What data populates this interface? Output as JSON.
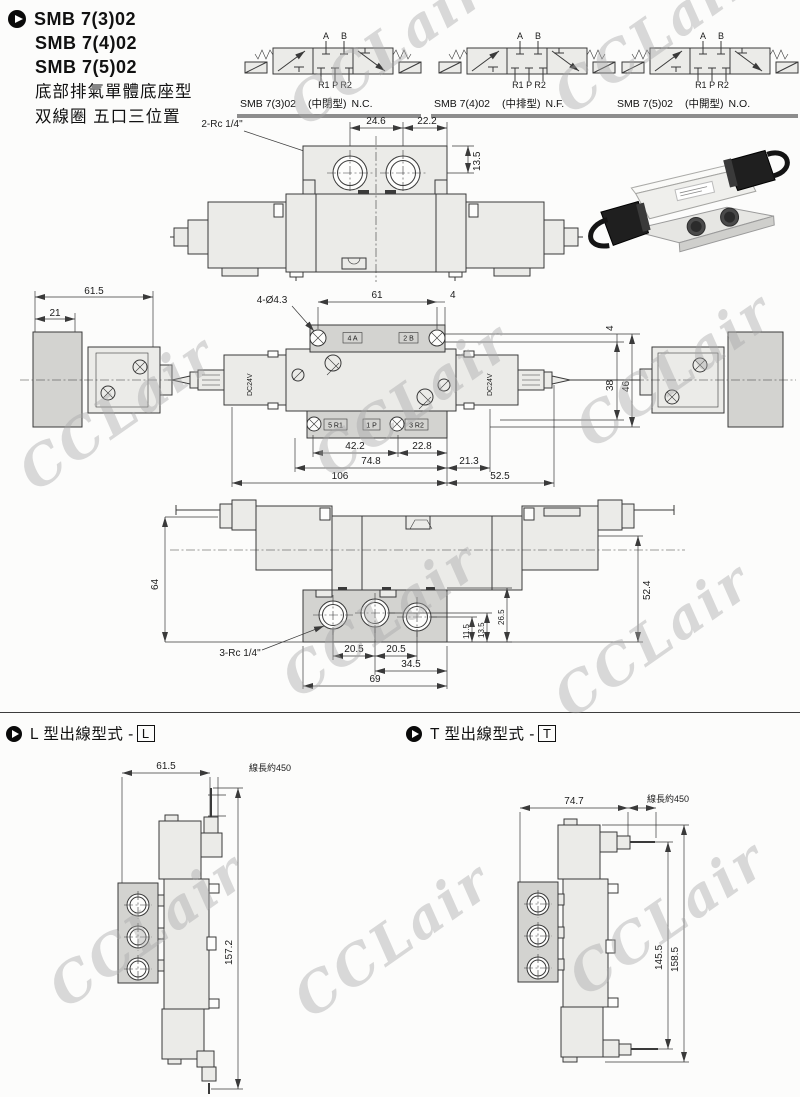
{
  "header": {
    "models": [
      "SMB 7(3)02",
      "SMB 7(4)02",
      "SMB 7(5)02"
    ],
    "subtitle1": "底部排氣單體底座型",
    "subtitle2": "双線圈 五口三位置"
  },
  "symbols": {
    "port_a": "A",
    "port_b": "B",
    "ports_bottom": "R1 P R2",
    "items": [
      {
        "model": "SMB 7(3)02",
        "variant": "(中閉型)",
        "suffix": "N.C."
      },
      {
        "model": "SMB 7(4)02",
        "variant": "(中排型)",
        "suffix": "N.F."
      },
      {
        "model": "SMB 7(5)02",
        "variant": "(中開型)",
        "suffix": "N.O."
      }
    ]
  },
  "top_view": {
    "port_label": "2-Rc 1/4\"",
    "d24_6": "24.6",
    "d22_2": "22.2",
    "d13_5": "13.5"
  },
  "plan_view": {
    "d61_5": "61.5",
    "d21": "21",
    "hole_label": "4-Ø4.3",
    "d61": "61",
    "d4_top": "4",
    "d4_right": "4",
    "d38": "38",
    "d46": "46",
    "coil_label": "DC24V",
    "plate_label_a": "4 A",
    "plate_label_b": "2 B",
    "port_r1": "5 R1",
    "port_p": "1 P",
    "port_r2": "3 R2",
    "d42_2": "42.2",
    "d22_8": "22.8",
    "d74_8": "74.8",
    "d21_3": "21.3",
    "d106": "106",
    "d52_5": "52.5"
  },
  "bottom_view": {
    "d64": "64",
    "d52_4": "52.4",
    "port_label": "3-Rc 1/4\"",
    "d11_5": "11.5",
    "d13_5": "13.5",
    "d26_5": "26.5",
    "d20_5a": "20.5",
    "d20_5b": "20.5",
    "d34_5": "34.5",
    "d69": "69"
  },
  "l_type": {
    "heading": "L 型出線型式 -",
    "badge": "L",
    "d61_5": "61.5",
    "wire_label": "線長約450",
    "d157_2": "157.2"
  },
  "t_type": {
    "heading": "T 型出線型式 -",
    "badge": "T",
    "d74_7": "74.7",
    "wire_label": "線長約450",
    "d145_5": "145.5",
    "d158_5": "158.5"
  },
  "watermark": "CCLair"
}
